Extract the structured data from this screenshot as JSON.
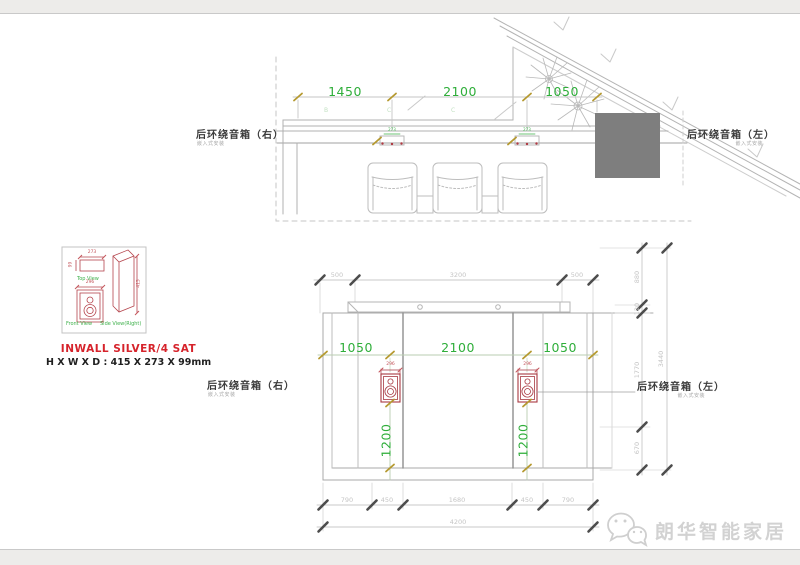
{
  "top_drawing": {
    "dims": [
      "1450",
      "2100",
      "1050"
    ],
    "plan_speaker_dims": [
      "273",
      "273"
    ],
    "grid_letters": [
      "B",
      "C",
      "C"
    ],
    "label_right": "后环绕音箱（右）",
    "label_right_sub": "嵌入式安装",
    "label_left": "后环绕音箱（左）",
    "label_left_sub": "嵌入式安装"
  },
  "detail": {
    "top_view_label": "Top View",
    "front_view_label": "Front View",
    "side_view_label": "Side View(Right)",
    "dim_width": "273",
    "dim_depth": "99",
    "dim_height": "415",
    "dim_cutout": "296",
    "product_name": "INWALL SILVER/4 SAT",
    "size_line": "H X W X D : 415 X 273 X 99mm"
  },
  "bottom_drawing": {
    "top_dims": [
      "500",
      "3200",
      "500"
    ],
    "green_dims": [
      "1050",
      "2100",
      "1050"
    ],
    "cutout_dims": [
      "296",
      "296"
    ],
    "height_dims": [
      "1200",
      "1200"
    ],
    "seg_dims": [
      "790",
      "450",
      "1680",
      "450",
      "790"
    ],
    "total_dim": "4200",
    "right_dims": [
      "880",
      "120",
      "1770",
      "670"
    ],
    "right_total": "3440",
    "label_right": "后环绕音箱（右）",
    "label_right_sub": "嵌入式安装",
    "label_left": "后环绕音箱（左）",
    "label_left_sub": "嵌入式安装"
  },
  "watermark": {
    "brand": "朗华智能家居"
  },
  "colors": {
    "dim_green": "#2fae3a",
    "tick_olive": "#b5992f",
    "tick_dark": "#4d4d4d",
    "detail_red": "#b5454d",
    "title_red": "#d6232b",
    "gray_box": "#7e7e7e",
    "watermark_gray": "#d2d2d2"
  }
}
